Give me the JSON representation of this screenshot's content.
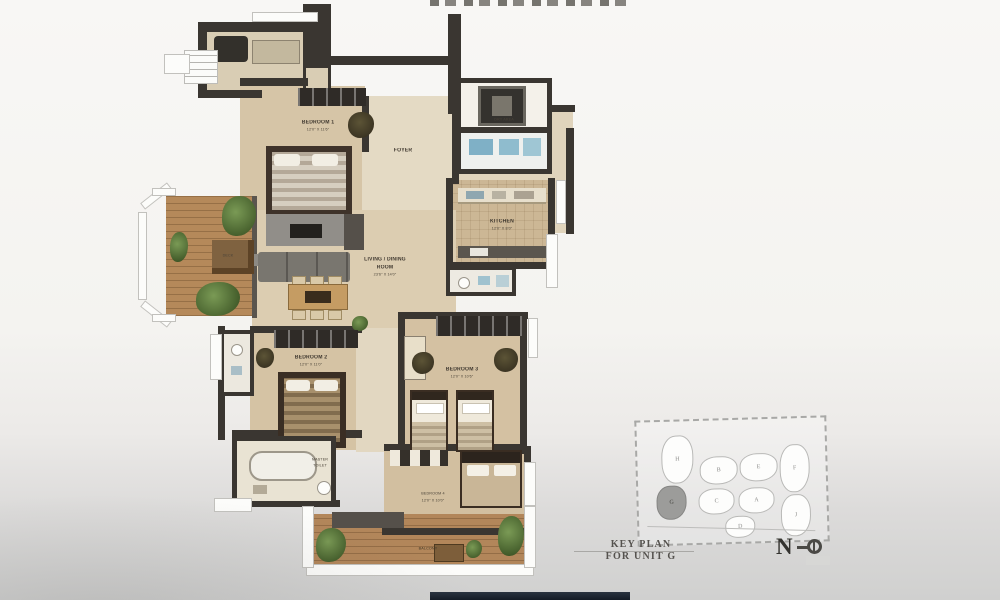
{
  "page": {
    "background": "#f4f3f0",
    "top_bar_color": "#1d2530"
  },
  "floorplan": {
    "labels": {
      "bedroom1": {
        "label": "BEDROOM 1",
        "dims": "12'0\" X 11'6\""
      },
      "foyer": {
        "label": "FOYER"
      },
      "dry_area": {
        "label": "DRY AREA"
      },
      "kitchen": {
        "label": "KITCHEN",
        "dims": "12'0\" X 8'0\""
      },
      "living": {
        "line1": "LIVING / DINING",
        "line2": "ROOM",
        "dims": "23'6\" X 14'0\""
      },
      "deck": {
        "label": "DECK"
      },
      "bedroom2": {
        "label": "BEDROOM 2",
        "dims": "12'0\" X 11'0\""
      },
      "master_toilet": {
        "line1": "MASTER",
        "line2": "TOILET"
      },
      "bedroom3": {
        "label": "BEDROOM 3",
        "dims": "12'0\" X 10'6\""
      },
      "bedroom4": {
        "label": "BEDROOM 4",
        "dims": "12'0\" X 10'0\""
      },
      "balcony": {
        "label": "BALCONY"
      }
    }
  },
  "keyplan": {
    "title_line1": "KEY PLAN",
    "title_line2": "FOR UNIT G",
    "units": [
      {
        "letter": "H",
        "shaded": false
      },
      {
        "letter": "B",
        "shaded": false
      },
      {
        "letter": "E",
        "shaded": false
      },
      {
        "letter": "F",
        "shaded": false
      },
      {
        "letter": "G",
        "shaded": true
      },
      {
        "letter": "C",
        "shaded": false
      },
      {
        "letter": "A",
        "shaded": false
      },
      {
        "letter": "J",
        "shaded": false
      },
      {
        "letter": "D",
        "shaded": false
      }
    ]
  },
  "north": {
    "label": "N"
  }
}
